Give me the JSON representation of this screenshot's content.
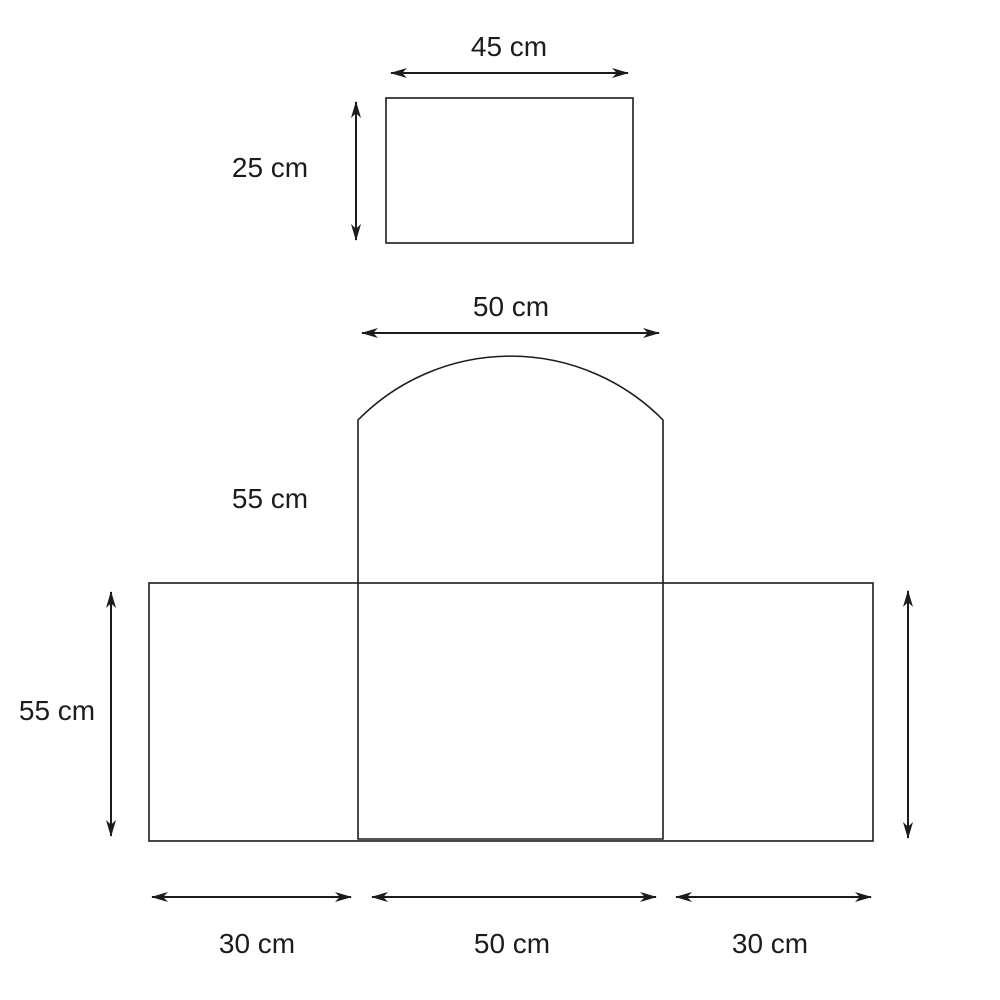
{
  "canvas": {
    "background": "#ffffff",
    "line_color": "#1c1c1c",
    "text_color": "#1c1c1c"
  },
  "top_rectangle": {
    "width_label": "45 cm",
    "height_label": "25 cm",
    "width_cm": 45,
    "height_cm": 25
  },
  "main_shape": {
    "arch_width_label": "50 cm",
    "panel_height_label": "55 cm",
    "side_height_label": "55 cm",
    "arch_width_cm": 50,
    "panel_height_cm": 55,
    "base_height_cm": 55,
    "bottom_segments": [
      {
        "label": "30 cm",
        "width_cm": 30
      },
      {
        "label": "50 cm",
        "width_cm": 50
      },
      {
        "label": "30 cm",
        "width_cm": 30
      }
    ]
  }
}
